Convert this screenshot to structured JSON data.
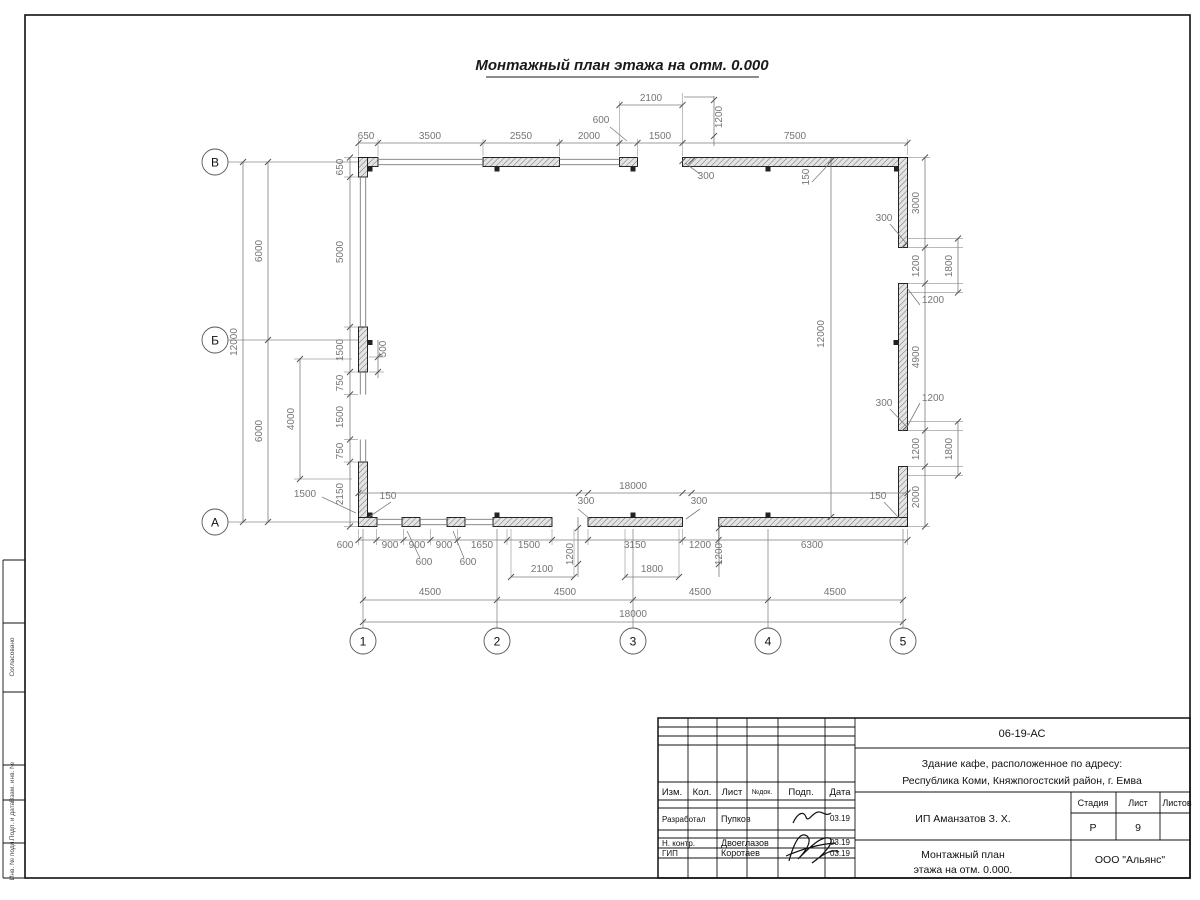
{
  "sheet": {
    "title": "Монтажный план этажа на отм. 0.000"
  },
  "axes": {
    "left": [
      {
        "label": "В",
        "x": 215,
        "y": 162
      },
      {
        "label": "Б",
        "x": 215,
        "y": 340
      },
      {
        "label": "А",
        "x": 215,
        "y": 522
      }
    ],
    "bottom": [
      {
        "label": "1",
        "x": 363,
        "y": 641
      },
      {
        "label": "2",
        "x": 497,
        "y": 641
      },
      {
        "label": "3",
        "x": 633,
        "y": 641
      },
      {
        "label": "4",
        "x": 768,
        "y": 641
      },
      {
        "label": "5",
        "x": 903,
        "y": 641
      }
    ]
  },
  "dims": [
    {
      "t": "2100",
      "x": 651,
      "y": 101
    },
    {
      "t": "600",
      "x": 601,
      "y": 123
    },
    {
      "t": "1200",
      "x": 722,
      "y": 117,
      "r": -90
    },
    {
      "t": "650",
      "x": 366,
      "y": 139
    },
    {
      "t": "3500",
      "x": 430,
      "y": 139
    },
    {
      "t": "2550",
      "x": 521,
      "y": 139
    },
    {
      "t": "2000",
      "x": 589,
      "y": 139
    },
    {
      "t": "1500",
      "x": 660,
      "y": 139
    },
    {
      "t": "7500",
      "x": 795,
      "y": 139
    },
    {
      "t": "300",
      "x": 706,
      "y": 179
    },
    {
      "t": "150",
      "x": 809,
      "y": 177,
      "r": -90
    },
    {
      "t": "12000",
      "x": 237,
      "y": 342,
      "r": -90
    },
    {
      "t": "6000",
      "x": 262,
      "y": 251,
      "r": -90
    },
    {
      "t": "6000",
      "x": 262,
      "y": 431,
      "r": -90
    },
    {
      "t": "650",
      "x": 343,
      "y": 167,
      "r": -90
    },
    {
      "t": "5000",
      "x": 343,
      "y": 252,
      "r": -90
    },
    {
      "t": "1500",
      "x": 343,
      "y": 350,
      "r": -90
    },
    {
      "t": "750",
      "x": 343,
      "y": 383,
      "r": -90
    },
    {
      "t": "1500",
      "x": 343,
      "y": 417,
      "r": -90
    },
    {
      "t": "750",
      "x": 343,
      "y": 451,
      "r": -90
    },
    {
      "t": "2150",
      "x": 343,
      "y": 494,
      "r": -90
    },
    {
      "t": "4000",
      "x": 294,
      "y": 419,
      "r": -90
    },
    {
      "t": "1500",
      "x": 305,
      "y": 497
    },
    {
      "t": "500",
      "x": 386,
      "y": 349,
      "r": -90
    },
    {
      "t": "150",
      "x": 388,
      "y": 499
    },
    {
      "t": "3000",
      "x": 919,
      "y": 203,
      "r": -90
    },
    {
      "t": "300",
      "x": 884,
      "y": 221
    },
    {
      "t": "1200",
      "x": 919,
      "y": 266,
      "r": -90
    },
    {
      "t": "1800",
      "x": 952,
      "y": 266,
      "r": -90
    },
    {
      "t": "1200",
      "x": 933,
      "y": 303
    },
    {
      "t": "4900",
      "x": 919,
      "y": 357,
      "r": -90
    },
    {
      "t": "300",
      "x": 884,
      "y": 406
    },
    {
      "t": "1200",
      "x": 933,
      "y": 401
    },
    {
      "t": "1200",
      "x": 919,
      "y": 449,
      "r": -90
    },
    {
      "t": "1800",
      "x": 952,
      "y": 449,
      "r": -90
    },
    {
      "t": "150",
      "x": 878,
      "y": 499
    },
    {
      "t": "2000",
      "x": 919,
      "y": 497,
      "r": -90
    },
    {
      "t": "12000",
      "x": 824,
      "y": 334,
      "r": -90
    },
    {
      "t": "18000",
      "x": 633,
      "y": 489
    },
    {
      "t": "300",
      "x": 586,
      "y": 504
    },
    {
      "t": "300",
      "x": 699,
      "y": 504
    },
    {
      "t": "600",
      "x": 345,
      "y": 548
    },
    {
      "t": "900",
      "x": 390,
      "y": 548
    },
    {
      "t": "900",
      "x": 417,
      "y": 548
    },
    {
      "t": "900",
      "x": 444,
      "y": 548
    },
    {
      "t": "1650",
      "x": 482,
      "y": 548
    },
    {
      "t": "1500",
      "x": 529,
      "y": 548
    },
    {
      "t": "1200",
      "x": 573,
      "y": 554,
      "r": -90
    },
    {
      "t": "3150",
      "x": 635,
      "y": 548
    },
    {
      "t": "1200",
      "x": 700,
      "y": 548
    },
    {
      "t": "1200",
      "x": 722,
      "y": 554,
      "r": -90
    },
    {
      "t": "6300",
      "x": 812,
      "y": 548
    },
    {
      "t": "600",
      "x": 424,
      "y": 565
    },
    {
      "t": "600",
      "x": 468,
      "y": 565
    },
    {
      "t": "2100",
      "x": 542,
      "y": 572
    },
    {
      "t": "1800",
      "x": 652,
      "y": 572
    },
    {
      "t": "4500",
      "x": 430,
      "y": 595
    },
    {
      "t": "4500",
      "x": 565,
      "y": 595
    },
    {
      "t": "4500",
      "x": 700,
      "y": 595
    },
    {
      "t": "4500",
      "x": 835,
      "y": 595
    },
    {
      "t": "18000",
      "x": 633,
      "y": 617
    }
  ],
  "side_column": {
    "labels": [
      {
        "t": "Согласовано",
        "x": 14,
        "y": 657
      },
      {
        "t": "Взам. инв. №",
        "x": 14,
        "y": 782
      },
      {
        "t": "Подп. и дата",
        "x": 14,
        "y": 821
      },
      {
        "t": "Инв. № подл.",
        "x": 14,
        "y": 860
      }
    ]
  },
  "title_block": {
    "doc_code": "06-19-АС",
    "project_line1": "Здание кафе, расположенное по адресу:",
    "project_line2": "Республика Коми, Княжпогостский район, г. Емва",
    "client": "ИП Аманзатов З. Х.",
    "drawing_name_line1": "Монтажный план",
    "drawing_name_line2": "этажа на отм. 0.000.",
    "organization": "ООО \"Альянс\"",
    "stage_label": "Стадия",
    "sheet_label": "Лист",
    "sheets_label": "Листов",
    "stage_value": "Р",
    "sheet_value": "9",
    "sheets_value": "",
    "columns": [
      "Изм.",
      "Кол.",
      "Лист",
      "№док.",
      "Подп.",
      "Дата"
    ],
    "rows": [
      {
        "role": "Разработал",
        "name": "Пупков",
        "date": "03.19"
      },
      {
        "role": "Н. контр.",
        "name": "Двоеглазов",
        "date": "03.19"
      },
      {
        "role": "ГИП",
        "name": "Коротаев",
        "date": "03.19"
      }
    ]
  },
  "colors": {
    "dim_text": "#757575",
    "line": "#111111",
    "wall_hatch": "#e4e4e4"
  }
}
